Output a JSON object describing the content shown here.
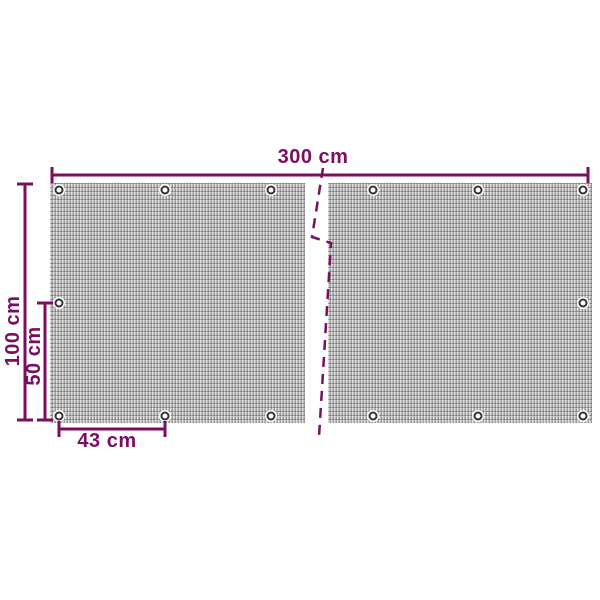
{
  "diagram": {
    "kind": "product dimension diagram",
    "subject": "balcony privacy screen mesh with eyelets, shown as two sections with a break line",
    "panels_shown": 2,
    "grommets_visible_per_panel": 7,
    "labels": {
      "total_width": "300 cm",
      "total_height": "100 cm",
      "half_height": "50 cm",
      "eyelet_spacing": "43 cm"
    },
    "colors": {
      "dimension_accent": "#7a0e60",
      "panel_fill": "#b9b9b9",
      "grommet_ring": "#333333",
      "background": "#ffffff"
    }
  }
}
